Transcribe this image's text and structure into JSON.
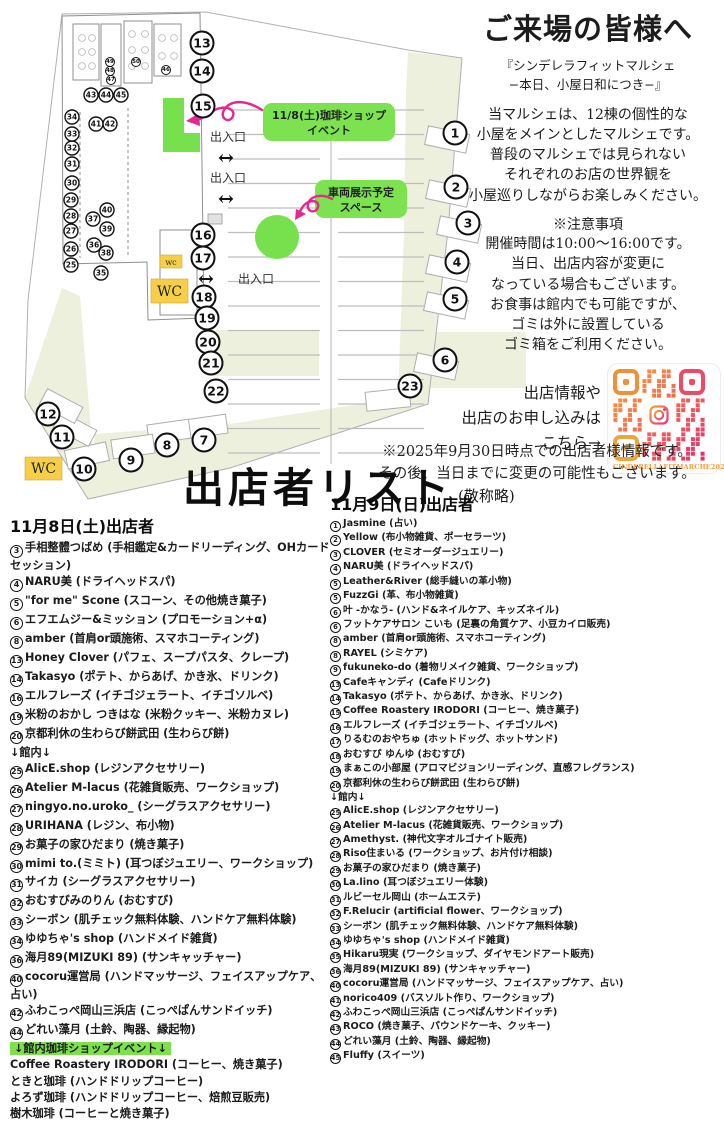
{
  "visitor": {
    "title": "ご来場の皆様へ",
    "subtitle": "『シンデレラフィットマルシェ\n−本日、小屋日和につき−』",
    "body": "当マルシェは、12棟の個性的な\n小屋をメインとしたマルシェです。\n普段のマルシェでは見られない\nそれぞれのお店の世界観を\n小屋巡りしながらお楽しみください。",
    "notice_title": "※注意事項",
    "notice": "開催時間は10:00〜16:00です。\n当日、出店内容が変更に\nなっている場合もございます。\nお食事は館内でも可能ですが、\nゴミは外に設置している\nゴミ箱をご利用ください。",
    "qr_lead": "出店情報や\n出店のお申し込みは\nこちら→",
    "qr_caption": "CINDERELLAFITMARCHE2024"
  },
  "update_note": "※2025年9月30日時点での出店者様情報です。\nその後、当日までに変更の可能性もございます。",
  "list_title": "出店者リスト",
  "list_title_suffix": "(敬称略)",
  "map": {
    "entrance": "出入口",
    "arrow": "↔",
    "wc": "WC",
    "wc_small": "wc",
    "event_label_1": "11/8(土)珈琲ショップ",
    "event_label_2": "イベント",
    "vehicle_label_1": "車両展示予定",
    "vehicle_label_2": "スペース",
    "accent_green": "#77e14d",
    "accent_pink": "#e8268f",
    "wc_yellow": "#f6cf47",
    "markers": [
      {
        "n": "1",
        "x": 455,
        "y": 133,
        "s": "b"
      },
      {
        "n": "2",
        "x": 456,
        "y": 187,
        "s": "b"
      },
      {
        "n": "3",
        "x": 468,
        "y": 223,
        "s": "b"
      },
      {
        "n": "4",
        "x": 457,
        "y": 262,
        "s": "b"
      },
      {
        "n": "5",
        "x": 455,
        "y": 299,
        "s": "b"
      },
      {
        "n": "6",
        "x": 445,
        "y": 360,
        "s": "b"
      },
      {
        "n": "7",
        "x": 204,
        "y": 440,
        "s": "b"
      },
      {
        "n": "8",
        "x": 167,
        "y": 445,
        "s": "b"
      },
      {
        "n": "9",
        "x": 131,
        "y": 460,
        "s": "b"
      },
      {
        "n": "10",
        "x": 84,
        "y": 469,
        "s": "b"
      },
      {
        "n": "11",
        "x": 62,
        "y": 437,
        "s": "b"
      },
      {
        "n": "12",
        "x": 48,
        "y": 414,
        "s": "b"
      },
      {
        "n": "13",
        "x": 202,
        "y": 43,
        "s": "b"
      },
      {
        "n": "14",
        "x": 202,
        "y": 71,
        "s": "b"
      },
      {
        "n": "15",
        "x": 203,
        "y": 106,
        "s": "b"
      },
      {
        "n": "16",
        "x": 203,
        "y": 235,
        "s": "b"
      },
      {
        "n": "17",
        "x": 203,
        "y": 258,
        "s": "b"
      },
      {
        "n": "18",
        "x": 204,
        "y": 297,
        "s": "b"
      },
      {
        "n": "19",
        "x": 207,
        "y": 318,
        "s": "b"
      },
      {
        "n": "20",
        "x": 208,
        "y": 342,
        "s": "b"
      },
      {
        "n": "21",
        "x": 211,
        "y": 363,
        "s": "b"
      },
      {
        "n": "22",
        "x": 216,
        "y": 391,
        "s": "b"
      },
      {
        "n": "23",
        "x": 410,
        "y": 386,
        "s": "b"
      },
      {
        "n": "25",
        "x": 71,
        "y": 265,
        "s": "s"
      },
      {
        "n": "26",
        "x": 71,
        "y": 249,
        "s": "s"
      },
      {
        "n": "27",
        "x": 71,
        "y": 231,
        "s": "s"
      },
      {
        "n": "28",
        "x": 71,
        "y": 216,
        "s": "s"
      },
      {
        "n": "29",
        "x": 71,
        "y": 200,
        "s": "s"
      },
      {
        "n": "30",
        "x": 72,
        "y": 183,
        "s": "s"
      },
      {
        "n": "31",
        "x": 72,
        "y": 164,
        "s": "s"
      },
      {
        "n": "32",
        "x": 72,
        "y": 148,
        "s": "s"
      },
      {
        "n": "33",
        "x": 72,
        "y": 134,
        "s": "s"
      },
      {
        "n": "34",
        "x": 72,
        "y": 117,
        "s": "s"
      },
      {
        "n": "35",
        "x": 101,
        "y": 273,
        "s": "s"
      },
      {
        "n": "36",
        "x": 94,
        "y": 245,
        "s": "s"
      },
      {
        "n": "37",
        "x": 93,
        "y": 219,
        "s": "s"
      },
      {
        "n": "38",
        "x": 106,
        "y": 253,
        "s": "s"
      },
      {
        "n": "39",
        "x": 107,
        "y": 229,
        "s": "s"
      },
      {
        "n": "40",
        "x": 107,
        "y": 210,
        "s": "s"
      },
      {
        "n": "41",
        "x": 96,
        "y": 124,
        "s": "s"
      },
      {
        "n": "42",
        "x": 110,
        "y": 124,
        "s": "s"
      },
      {
        "n": "43",
        "x": 91,
        "y": 95,
        "s": "s"
      },
      {
        "n": "44",
        "x": 106,
        "y": 95,
        "s": "s"
      },
      {
        "n": "45",
        "x": 121,
        "y": 95,
        "s": "s"
      },
      {
        "n": "46",
        "x": 166,
        "y": 70,
        "s": "t"
      },
      {
        "n": "47",
        "x": 111,
        "y": 80,
        "s": "t"
      },
      {
        "n": "48",
        "x": 110,
        "y": 71,
        "s": "t"
      },
      {
        "n": "49",
        "x": 110,
        "y": 62,
        "s": "t"
      },
      {
        "n": "50",
        "x": 136,
        "y": 62,
        "s": "t"
      }
    ]
  },
  "saturday": {
    "header": "11月8日(土)出店者",
    "items": [
      {
        "n": "3",
        "t": "手相整體つばめ (手相鑑定&カードリーディング、OHカードセッション)"
      },
      {
        "n": "4",
        "t": "NARU美 (ドライヘッドスパ)"
      },
      {
        "n": "5",
        "t": "\"for me\" Scone (スコーン、その他焼き菓子)"
      },
      {
        "n": "6",
        "t": "エフエムジー&ミッション (プロモーション+α)"
      },
      {
        "n": "8",
        "t": "amber (首肩or頭施術、スマホコーティング)"
      },
      {
        "n": "13",
        "t": "Honey Clover (パフェ、スープパスタ、クレープ)"
      },
      {
        "n": "14",
        "t": "Takasyo (ポテト、からあげ、かき氷、ドリンク)"
      },
      {
        "n": "16",
        "t": "エルフレーズ (イチゴジェラート、イチゴソルベ)"
      },
      {
        "n": "19",
        "t": "米粉のおかし つきはな (米粉クッキー、米粉カヌレ)"
      },
      {
        "n": "20",
        "t": "京都利休の生わらび餅武田 (生わらび餅)"
      },
      {
        "n": "",
        "t": "↓館内↓",
        "style": "plain"
      },
      {
        "n": "25",
        "t": "AlicE.shop (レジンアクセサリー)"
      },
      {
        "n": "26",
        "t": "Atelier M-lacus (花雑貨販売、ワークショップ)"
      },
      {
        "n": "27",
        "t": "ningyo.no.uroko_ (シーグラスアクセサリー)"
      },
      {
        "n": "28",
        "t": "URIHANA (レジン、布小物)"
      },
      {
        "n": "29",
        "t": "お菓子の家ひだまり (焼き菓子)"
      },
      {
        "n": "30",
        "t": "mimi to.(ミミト) (耳つぼジュエリー、ワークショップ)"
      },
      {
        "n": "31",
        "t": "サイカ (シーグラスアクセサリー)"
      },
      {
        "n": "32",
        "t": "おむすびみのりん (おむすび)"
      },
      {
        "n": "33",
        "t": "シーボン (肌チェック無料体験、ハンドケア無料体験)"
      },
      {
        "n": "34",
        "t": "ゆゆちゃ's shop (ハンドメイド雑貨)"
      },
      {
        "n": "36",
        "t": "海月89(MIZUKI 89) (サンキャッチャー)"
      },
      {
        "n": "40",
        "t": "cocoru運営局 (ハンドマッサージ、フェイスアップケア、占い)"
      },
      {
        "n": "42",
        "t": "ふわこっぺ岡山三浜店 (こっぺぱんサンドイッチ)"
      },
      {
        "n": "44",
        "t": "どれい藻月 (土鈴、陶器、縁起物)"
      },
      {
        "n": "",
        "t": "↓館内珈琲ショップイベント↓",
        "style": "highlight"
      },
      {
        "n": "",
        "t": "Coffee Roastery IRODORI (コーヒー、焼き菓子)"
      },
      {
        "n": "",
        "t": "ときと珈琲 (ハンドドリップコーヒー)"
      },
      {
        "n": "",
        "t": "よろず珈琲 (ハンドドリップコーヒー、焙煎豆販売)"
      },
      {
        "n": "",
        "t": "樹木珈琲 (コーヒーと焼き菓子)"
      }
    ]
  },
  "sunday": {
    "header": "11月9日(日)出店者",
    "items": [
      {
        "n": "1",
        "t": "Jasmine (占い)"
      },
      {
        "n": "2",
        "t": "Yellow (布小物雑貨、ポーセラーツ)"
      },
      {
        "n": "3",
        "t": "CLOVER (セミオーダージュエリー)"
      },
      {
        "n": "4",
        "t": "NARU美 (ドライヘッドスパ)"
      },
      {
        "n": "5",
        "t": "Leather&River (総手縫いの革小物)"
      },
      {
        "n": "5",
        "t": "FuzzGi (革、布小物雑貨)"
      },
      {
        "n": "6",
        "t": "叶 -かなう- (ハンド&ネイルケア、キッズネイル)"
      },
      {
        "n": "6",
        "t": "フットケアサロン こいも (足裏の角質ケア、小豆カイロ販売)"
      },
      {
        "n": "8",
        "t": "amber (首肩or頭施術、スマホコーティング)"
      },
      {
        "n": "8",
        "t": "RAYEL (シミケア)"
      },
      {
        "n": "9",
        "t": "fukuneko-do (着物リメイク雑貨、ワークショップ)"
      },
      {
        "n": "13",
        "t": "Cafeキャンディ (Cafeドリンク)"
      },
      {
        "n": "14",
        "t": "Takasyo (ポテト、からあげ、かき氷、ドリンク)"
      },
      {
        "n": "15",
        "t": "Coffee Roastery IRODORI (コーヒー、焼き菓子)"
      },
      {
        "n": "16",
        "t": "エルフレーズ (イチゴジェラート、イチゴソルベ)"
      },
      {
        "n": "17",
        "t": "りるむのおやちゅ (ホットドッグ、ホットサンド)"
      },
      {
        "n": "18",
        "t": "おむすび ゆんゆ (おむすび)"
      },
      {
        "n": "19",
        "t": "まぁこの小部屋 (アロマビジョンリーディング、直感フレグランス)"
      },
      {
        "n": "20",
        "t": "京都利休の生わらび餅武田 (生わらび餅)"
      },
      {
        "n": "",
        "t": "↓館内↓",
        "style": "plain"
      },
      {
        "n": "25",
        "t": "AlicE.shop (レジンアクセサリー)"
      },
      {
        "n": "26",
        "t": "Atelier M-lacus (花雑貨販売、ワークショップ)"
      },
      {
        "n": "27",
        "t": "Amethyst. (神代文字オルゴナイト販売)"
      },
      {
        "n": "28",
        "t": "Riso住まいる (ワークショップ、お片付け相談)"
      },
      {
        "n": "29",
        "t": "お菓子の家ひだまり (焼き菓子)"
      },
      {
        "n": "30",
        "t": "La.lino (耳つぼジュエリー体験)"
      },
      {
        "n": "31",
        "t": "ルビーセル岡山 (ホームエステ)"
      },
      {
        "n": "32",
        "t": "F.Relucir (artificial flower、ワークショップ)"
      },
      {
        "n": "33",
        "t": "シーボン (肌チェック無料体験、ハンドケア無料体験)"
      },
      {
        "n": "34",
        "t": "ゆゆちゃ's shop (ハンドメイド雑貨)"
      },
      {
        "n": "35",
        "t": "Hikaru現実 (ワークショップ、ダイヤモンドアート販売)"
      },
      {
        "n": "36",
        "t": "海月89(MIZUKI 89) (サンキャッチャー)"
      },
      {
        "n": "40",
        "t": "cocoru運営局 (ハンドマッサージ、フェイスアップケア、占い)"
      },
      {
        "n": "41",
        "t": "norico409 (バスソルト作り、ワークショップ)"
      },
      {
        "n": "42",
        "t": "ふわこっぺ岡山三浜店 (こっぺぱんサンドイッチ)"
      },
      {
        "n": "43",
        "t": "ROCO (焼き菓子、パウンドケーキ、クッキー)"
      },
      {
        "n": "44",
        "t": "どれい藻月 (土鈴、陶器、縁起物)"
      },
      {
        "n": "45",
        "t": "Fluffy (スイーツ)"
      }
    ]
  }
}
